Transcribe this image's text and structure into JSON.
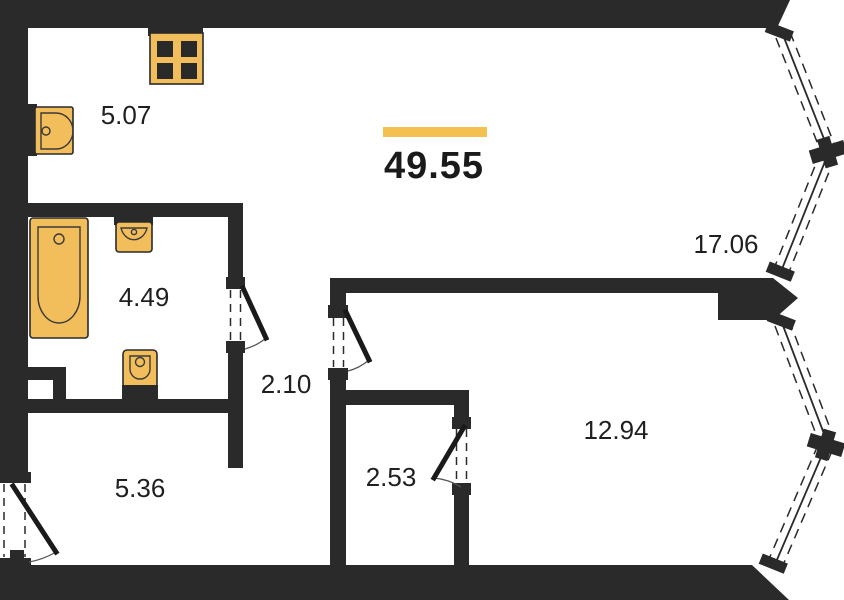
{
  "plan": {
    "title": "apartment-floor-plan",
    "total_area": "49.55",
    "rooms": [
      {
        "name": "kitchen-niche",
        "area": "5.07"
      },
      {
        "name": "bathroom",
        "area": "4.49"
      },
      {
        "name": "corridor",
        "area": "2.10"
      },
      {
        "name": "hallway",
        "area": "5.36"
      },
      {
        "name": "wardrobe",
        "area": "2.53"
      },
      {
        "name": "bedroom",
        "area": "12.94"
      },
      {
        "name": "living-room",
        "area": "17.06"
      }
    ],
    "fixtures": [
      {
        "icon": "stove-icon",
        "meaning": "4-burner cooktop"
      },
      {
        "icon": "kitchen-sink-icon",
        "meaning": "kitchen sink"
      },
      {
        "icon": "bathtub-icon",
        "meaning": "bathtub"
      },
      {
        "icon": "washbasin-icon",
        "meaning": "wash basin"
      },
      {
        "icon": "toilet-icon",
        "meaning": "toilet"
      }
    ],
    "colors": {
      "wall": "#2a2a2a",
      "fixture_fill": "#f2be5b",
      "accent_bar": "#f4c150",
      "label_text": "#1f1f1f",
      "background": "#ffffff"
    }
  }
}
